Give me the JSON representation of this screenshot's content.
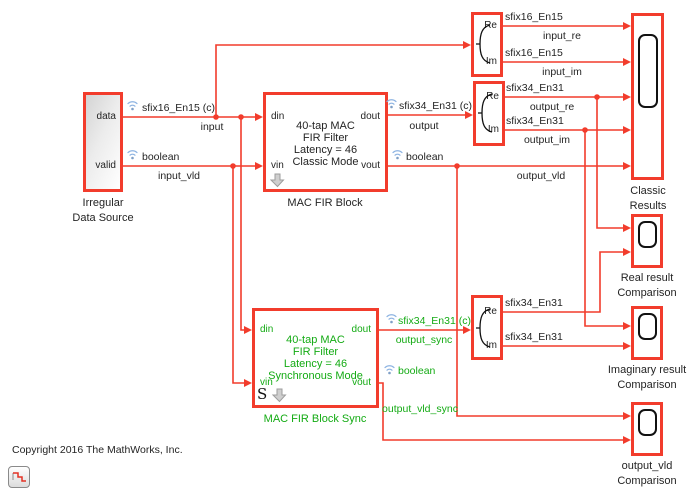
{
  "copyright": "Copyright 2016 The MathWorks, Inc.",
  "colors": {
    "rate_classic_red": "#f23c2c",
    "rate_sync_green": "#14ab14"
  },
  "source": {
    "ports": [
      "data",
      "valid"
    ],
    "label": [
      "Irregular",
      "Data Source"
    ]
  },
  "fir_classic": {
    "body": [
      "40-tap MAC",
      "FIR Filter",
      "Latency = 46",
      "Classic Mode"
    ],
    "ports": [
      "din",
      "vin",
      "dout",
      "vout"
    ],
    "label": "MAC FIR Block"
  },
  "fir_sync": {
    "body": [
      "40-tap MAC",
      "FIR Filter",
      "Latency = 46",
      "Synchronous Mode"
    ],
    "ports": [
      "din",
      "vin",
      "dout",
      "vout"
    ],
    "label": "MAC FIR Block Sync",
    "s_badge": "S"
  },
  "reim": {
    "re": "Re",
    "im": "Im"
  },
  "scopes": {
    "classic": [
      "Classic",
      "Results"
    ],
    "real": [
      "Real result",
      "Comparison"
    ],
    "imag": [
      "Imaginary result",
      "Comparison"
    ],
    "vld": [
      "output_vld",
      "Comparison"
    ]
  },
  "signals": {
    "input": {
      "type": "sfix16_En15 (c)",
      "name": "input"
    },
    "input_vld": {
      "type": "boolean",
      "name": "input_vld"
    },
    "output": {
      "type": "sfix34_En31 (c)",
      "name": "output"
    },
    "output_vld": {
      "type": "boolean",
      "name": "output_vld"
    },
    "input_re": {
      "type": "sfix16_En15",
      "name": "input_re"
    },
    "input_im": {
      "type": "sfix16_En15",
      "name": "input_im"
    },
    "output_re": {
      "type": "sfix34_En31",
      "name": "output_re"
    },
    "output_im": {
      "type": "sfix34_En31",
      "name": "output_im"
    },
    "sync_re": {
      "type": "sfix34_En31"
    },
    "sync_im": {
      "type": "sfix34_En31"
    },
    "output_sync": {
      "type": "sfix34_En31 (c)",
      "name": "output_sync"
    },
    "output_vld_sync": {
      "type": "boolean",
      "name": "output_vld_sync"
    }
  }
}
